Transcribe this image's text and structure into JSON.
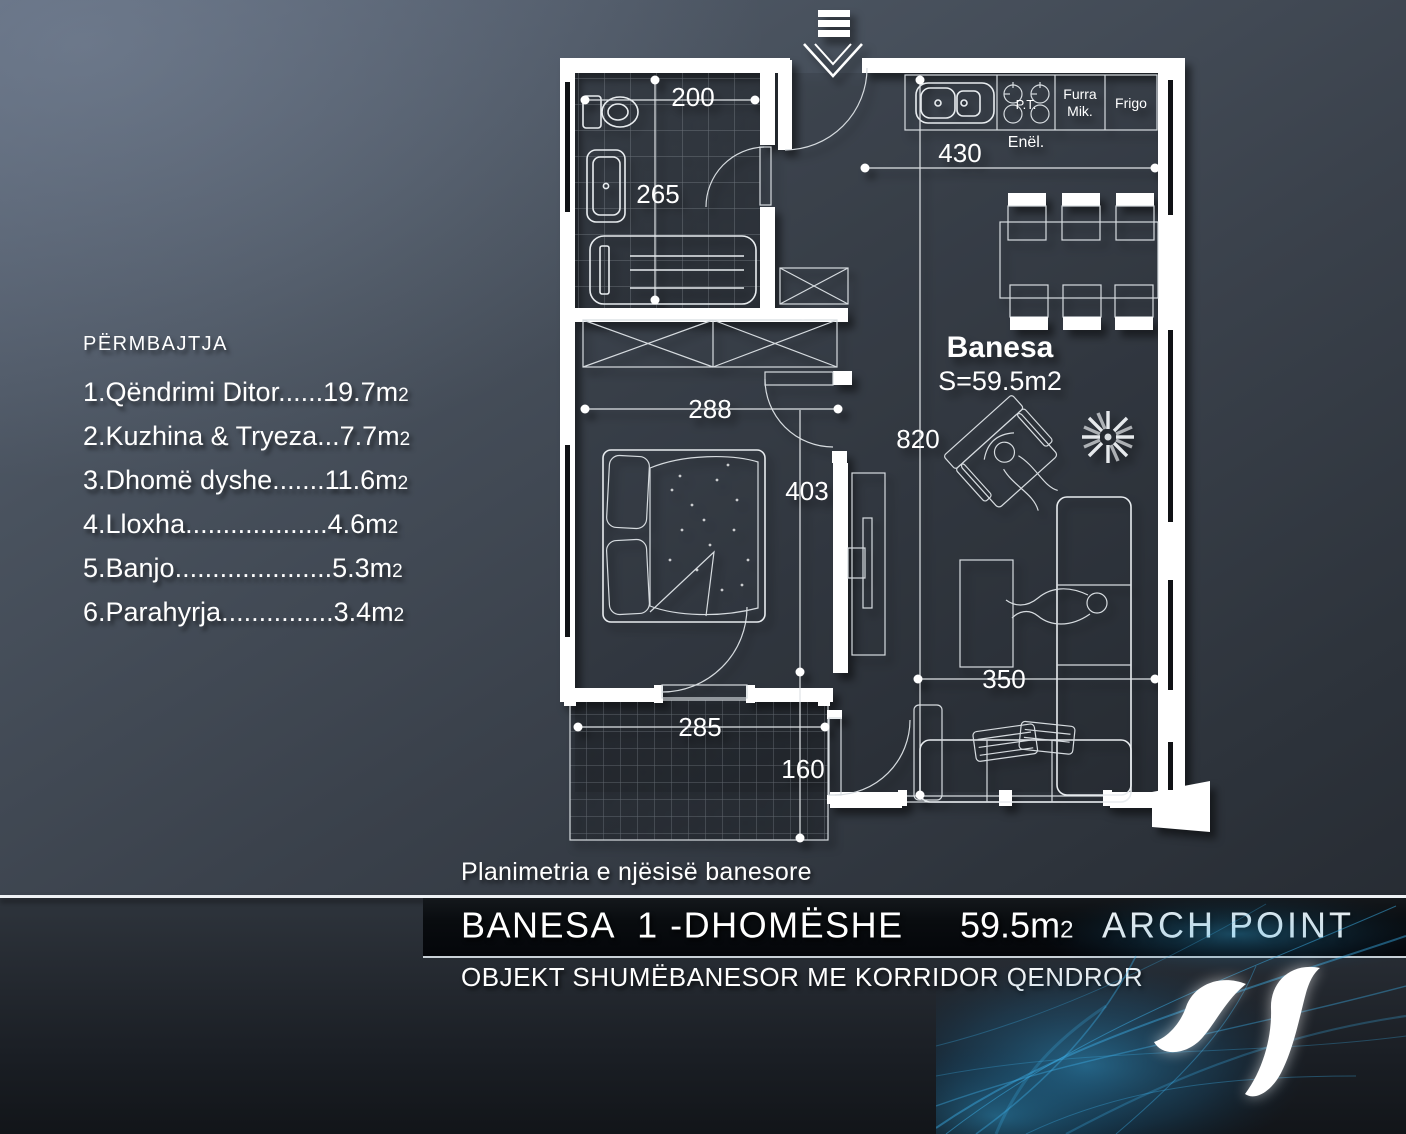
{
  "legend": {
    "title": "PËRMBAJTJA",
    "items": [
      {
        "text": "1.Qëndrimi Ditor......19.7m",
        "sub": "2"
      },
      {
        "text": "2.Kuzhina & Tryeza...7.7m",
        "sub": "2"
      },
      {
        "text": "3.Dhomë dyshe.......11.6m",
        "sub": "2"
      },
      {
        "text": "4.Lloxha...................4.6m",
        "sub": "2"
      },
      {
        "text": "5.Banjo.....................5.3m",
        "sub": "2"
      },
      {
        "text": "6.Parahyrja...............3.4m",
        "sub": "2"
      }
    ]
  },
  "plan": {
    "unit_label": "Banesa",
    "unit_area": "S=59.5m2",
    "dims": {
      "bath_w": "200",
      "bath_h": "265",
      "kitchen_w": "430",
      "bed_w": "288",
      "living_h": "820",
      "bed_h": "403",
      "balcony_w": "285",
      "balcony_h": "160",
      "living_w": "350"
    },
    "kitchen": {
      "enel": "Enël.",
      "pt": "P.T.",
      "furra_1": "Furra",
      "furra_2": "Mik.",
      "frigo": "Frigo"
    }
  },
  "caption": "Planimetria e njësisë banesore",
  "band": {
    "title": "BANESA  1 -DHOMËSHE",
    "area": "59.5m",
    "area_sub": "2",
    "brand": "ARCH POINT"
  },
  "subtitle": "OBJEKT SHUMËBANESOR ME KORRIDOR QENDROR",
  "colors": {
    "background_top": "#5a6577",
    "background_bottom": "#171b20",
    "wall": "#ffffff",
    "accent_blue": "#2a8fc4",
    "band_bg": "#07090c"
  }
}
